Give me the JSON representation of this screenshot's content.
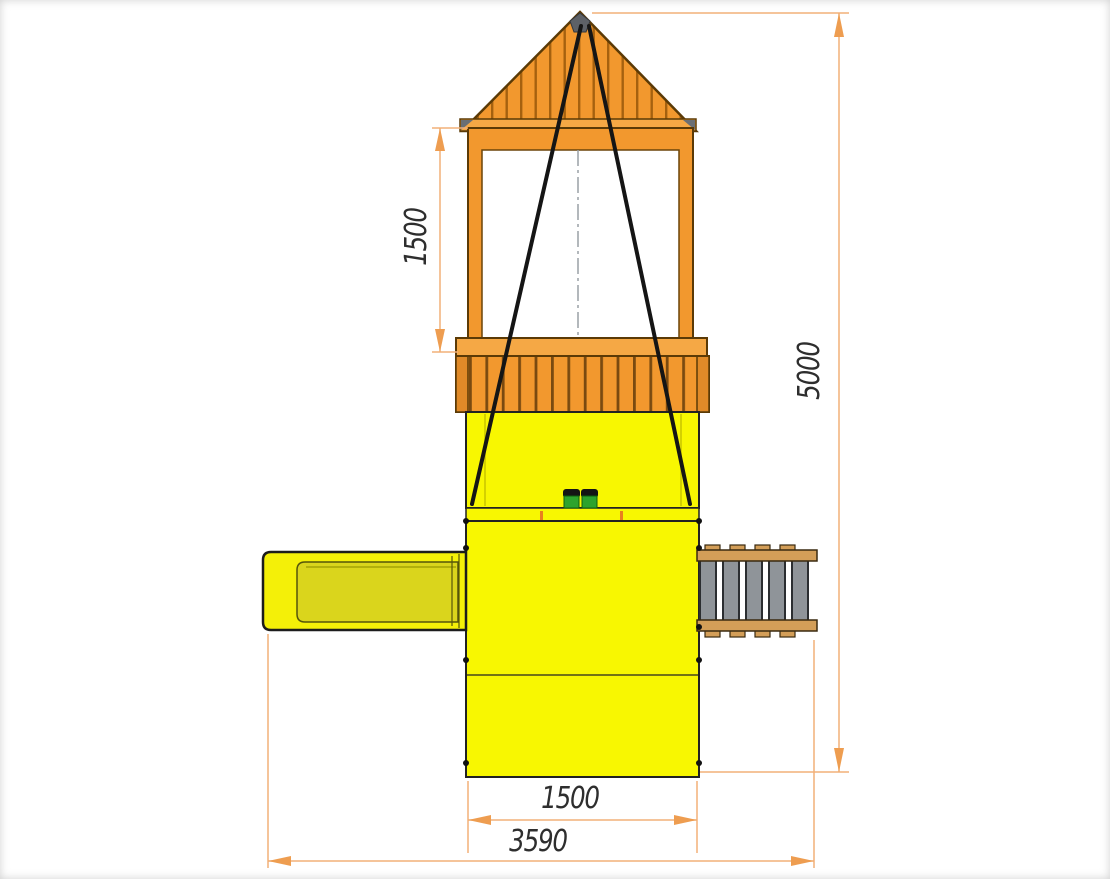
{
  "drawing": {
    "dimensions": {
      "window_height": "1500",
      "total_height": "5000",
      "platform_width": "1500",
      "total_width": "3590"
    },
    "palette": {
      "wood_orange": "#F2982E",
      "wood_orange_dark": "#A5610F",
      "fascia_orange": "#F5A845",
      "panel_yellow": "#F8F701",
      "slide_trough_yellow": "#DAD51C",
      "step_gray": "#8F9499",
      "ladder_rail_tan": "#D39E58",
      "seat_green": "#2DA32D",
      "roof_cap_gray": "#5D6167",
      "centerline_gray": "#9AA0A6",
      "dimension_line": "#F2B078",
      "dimension_arrow": "#EE9D50",
      "dimension_text": "#2E2E2E",
      "outline_dark": "#5B3A06",
      "outline_black": "#1F1F1F"
    }
  }
}
